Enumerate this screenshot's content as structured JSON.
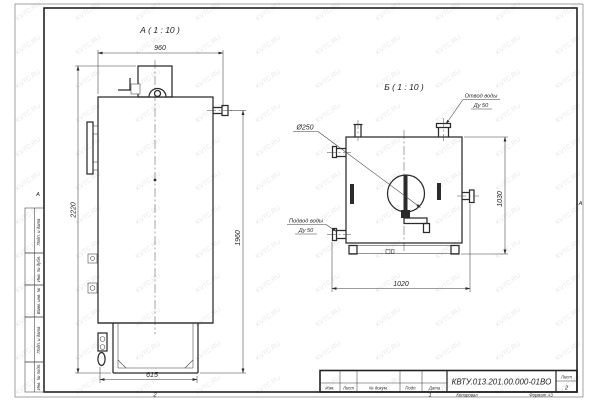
{
  "frame": {
    "zone_left": "А",
    "zone_right": "А",
    "zone_bottom_left": "2",
    "zone_bottom_right": "1",
    "footer_copied": "Копировал",
    "footer_format": "Формат А3",
    "side_column": [
      "Подп. и дата",
      "Инв. № дубл.",
      "Взам. инв. №",
      "Подп. и дата",
      "Инв. № подл."
    ]
  },
  "title_block": {
    "doc_number": "КВТУ.013.201.00.000-01ВО",
    "col_izm": "Изм.",
    "col_list": "Лист",
    "col_docnum": "№ докум.",
    "col_podp": "Подп.",
    "col_data": "Дата",
    "sheet_label": "Лист",
    "sheet_number": "2"
  },
  "view_a": {
    "label": "А ( 1 : 10 )",
    "dim_top": "960",
    "dim_left": "2220",
    "dim_right": "1960",
    "dim_bottom": "615"
  },
  "view_b": {
    "label": "Б ( 1 : 10 )",
    "dim_bottom": "1020",
    "dim_right": "1030",
    "flue_label": "Ø250",
    "outlet_label": "Отвод воды",
    "outlet_dn": "Ду 50",
    "inlet_label": "Подвод воды",
    "inlet_dn": "Ду 50"
  },
  "watermark": {
    "text": "KVTC.RU"
  },
  "colors": {
    "line": "#2b2b2b",
    "thin": "#3d3d3d",
    "watermark": "#e7e7e7",
    "paper": "#ffffff"
  }
}
